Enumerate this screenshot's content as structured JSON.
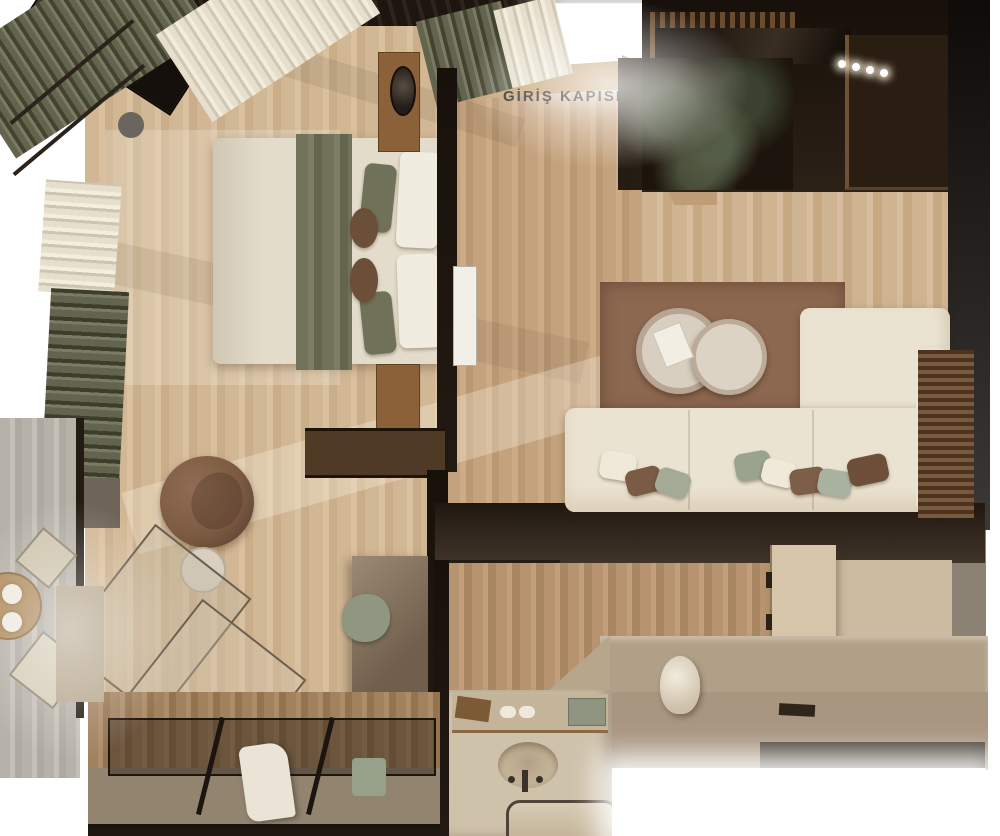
{
  "scene": {
    "type": "top-down 3D architectural render of a hotel suite",
    "rooms": [
      "bedroom",
      "entry-hall",
      "living-area",
      "bathroom",
      "walk-in-closet",
      "balcony",
      "desk-nook"
    ],
    "furniture": [
      "double-bed",
      "tv",
      "nightstands",
      "pendant-lamp",
      "armchair",
      "side-table",
      "sectional-sofa",
      "round-coffee-tables",
      "area-rug",
      "minibar-console",
      "hanging-plant",
      "desk",
      "desk-chair",
      "vanity-sink",
      "mirror",
      "bathroom-door",
      "vase",
      "glass-top-wardrobe",
      "bathrobe",
      "balcony-table",
      "balcony-chairs",
      "curtains"
    ]
  },
  "entrance": {
    "label": "GİRİŞ KAPISI"
  },
  "colors": {
    "bg": "#ffffff",
    "wall-dark": "#221a12",
    "floor-bed": "#d1b794",
    "floor-entry": "#c4a27d",
    "floor-living": "#cfb492",
    "rug": "#8d6850",
    "sofa": "#ebe3d1",
    "duvet": "#e3dcca",
    "throw-olive": "#71725a",
    "pillow-olive": "#6f7158",
    "pillow-sage": "#a3ab96",
    "pillow-brown": "#7a5c45",
    "armchair": "#7d5b43",
    "marble": "#d9cfc0",
    "stone": "#b1a088",
    "vanity": "#cfc2ab",
    "concrete": "#92846f",
    "curtain-cream": "#e6dfcd",
    "curtain-olive": "#62644e",
    "wood-dark": "#7a5731",
    "bath-wood": "#b7946f",
    "plaster": "#cdbba1",
    "label-text": "#2d2b27"
  }
}
